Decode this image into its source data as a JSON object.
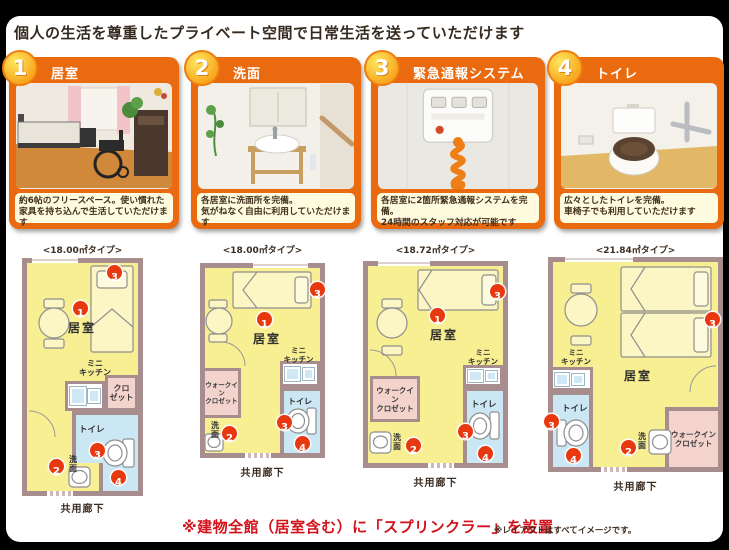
{
  "page": {
    "title": "個人の生活を尊重したプライベート空間で日常生活を送っていただけます",
    "footnote_main": "※建物全館（居室含む）に「スプリンクラー」を設置",
    "footnote_sub": "※レイアウトはすべてイメージです。"
  },
  "features": [
    {
      "num": "1",
      "title": "居室",
      "cap1": "約6帖のフリースペース。使い慣れた",
      "cap2": "家具を持ち込んで生活していただけます"
    },
    {
      "num": "2",
      "title": "洗面",
      "cap1": "各居室に洗面所を完備。",
      "cap2": "気がねなく自由に利用していただけます"
    },
    {
      "num": "3",
      "title": "緊急通報システム",
      "cap1": "各居室に2箇所緊急通報システムを完備。",
      "cap2": "24時間のスタッフ対応が可能です"
    },
    {
      "num": "4",
      "title": "トイレ",
      "cap1": "広々としたトイレを完備。",
      "cap2": "車椅子でも利用していただけます"
    }
  ],
  "labels": {
    "room": "居室",
    "kitchen1": "ミニ",
    "kitchen2": "キッチン",
    "toilet": "トイレ",
    "wash": "洗面",
    "closet1": "クロ",
    "closet2": "ゼット",
    "wic1": "ウォークイン",
    "wic2": "クロゼット",
    "corridor": "共用廊下"
  },
  "badges": {
    "b1": "1",
    "b2": "2",
    "b3": "3",
    "b4": "4"
  },
  "plans": [
    {
      "type_label": "<18.00㎡タイプ>"
    },
    {
      "type_label": "<18.00㎡タイプ>"
    },
    {
      "type_label": "<18.72㎡タイプ>"
    },
    {
      "type_label": "<21.84㎡タイプ>"
    }
  ]
}
